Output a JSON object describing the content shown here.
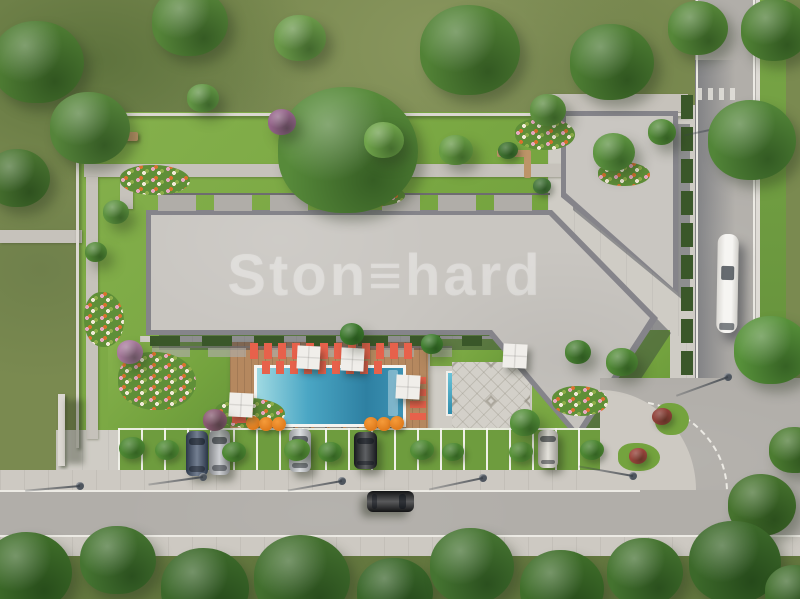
{
  "watermark": {
    "text": "Ston≡hard"
  },
  "palette": {
    "meadow": "#7a8a50",
    "lawn": "#74a33e",
    "lawnLight": "#86b14d",
    "paving": "#cfccc5",
    "path": "#c6c2bb",
    "road": "#b1aea9",
    "sidewalk": "#cdc9c2",
    "roofLight": "#c9c6c1",
    "roofEdge": "#85848a",
    "shadow": "#2e3440",
    "deck": "#b5885f",
    "coral": "#e7614b",
    "orangeUmb": "#e07b1c",
    "hedge": "#3a5729"
  },
  "scene": {
    "trees": [
      {
        "x": 38,
        "y": 62,
        "r": 46,
        "c": "#4e7c33"
      },
      {
        "x": 90,
        "y": 128,
        "r": 40,
        "c": "#55843a"
      },
      {
        "x": 18,
        "y": 178,
        "r": 32,
        "c": "#4a7531"
      },
      {
        "x": 190,
        "y": 22,
        "r": 38,
        "c": "#568539"
      },
      {
        "x": 300,
        "y": 38,
        "r": 26,
        "c": "#6b9a49"
      },
      {
        "x": 348,
        "y": 150,
        "r": 70,
        "c": "#578a3a"
      },
      {
        "x": 470,
        "y": 50,
        "r": 50,
        "c": "#528236"
      },
      {
        "x": 612,
        "y": 62,
        "r": 42,
        "c": "#4d7d33"
      },
      {
        "x": 548,
        "y": 110,
        "r": 18,
        "c": "#5d8f3f"
      },
      {
        "x": 698,
        "y": 28,
        "r": 30,
        "c": "#568739"
      },
      {
        "x": 775,
        "y": 30,
        "r": 34,
        "c": "#4f8034"
      },
      {
        "x": 752,
        "y": 140,
        "r": 44,
        "c": "#528538"
      },
      {
        "x": 772,
        "y": 350,
        "r": 38,
        "c": "#57913a"
      },
      {
        "x": 795,
        "y": 450,
        "r": 26,
        "c": "#4c7c31"
      },
      {
        "x": 762,
        "y": 505,
        "r": 34,
        "c": "#46732e"
      },
      {
        "x": 384,
        "y": 140,
        "r": 20,
        "c": "#6fa34a"
      },
      {
        "x": 456,
        "y": 150,
        "r": 17,
        "c": "#679c43"
      },
      {
        "x": 614,
        "y": 152,
        "r": 21,
        "c": "#5d9440"
      },
      {
        "x": 662,
        "y": 132,
        "r": 14,
        "c": "#548c39"
      },
      {
        "x": 282,
        "y": 122,
        "r": 14,
        "c": "#95648a"
      },
      {
        "x": 203,
        "y": 98,
        "r": 16,
        "c": "#639745"
      },
      {
        "x": 116,
        "y": 212,
        "r": 13,
        "c": "#5d9240"
      },
      {
        "x": 96,
        "y": 252,
        "r": 11,
        "c": "#548a38"
      },
      {
        "x": 352,
        "y": 334,
        "r": 12,
        "c": "#3e7b2e"
      },
      {
        "x": 432,
        "y": 344,
        "r": 11,
        "c": "#417f30"
      },
      {
        "x": 525,
        "y": 422,
        "r": 15,
        "c": "#55903a"
      },
      {
        "x": 578,
        "y": 352,
        "r": 13,
        "c": "#4a8234"
      },
      {
        "x": 622,
        "y": 362,
        "r": 16,
        "c": "#538c38"
      },
      {
        "x": 215,
        "y": 420,
        "r": 12,
        "c": "#8a5a72"
      },
      {
        "x": 130,
        "y": 352,
        "r": 13,
        "c": "#a8799c"
      },
      {
        "x": 28,
        "y": 572,
        "r": 44,
        "c": "#3f6e2a"
      },
      {
        "x": 118,
        "y": 560,
        "r": 38,
        "c": "#457431"
      },
      {
        "x": 205,
        "y": 588,
        "r": 44,
        "c": "#3c692a"
      },
      {
        "x": 302,
        "y": 578,
        "r": 48,
        "c": "#426f2e"
      },
      {
        "x": 395,
        "y": 592,
        "r": 38,
        "c": "#3a672a"
      },
      {
        "x": 472,
        "y": 566,
        "r": 42,
        "c": "#457431"
      },
      {
        "x": 562,
        "y": 588,
        "r": 42,
        "c": "#3f6e2a"
      },
      {
        "x": 645,
        "y": 572,
        "r": 38,
        "c": "#44732f"
      },
      {
        "x": 735,
        "y": 562,
        "r": 46,
        "c": "#3c692a"
      },
      {
        "x": 795,
        "y": 592,
        "r": 30,
        "c": "#426f2e"
      }
    ],
    "bushes": [
      {
        "x": 132,
        "y": 448,
        "r": 13,
        "c": "#4d8833"
      },
      {
        "x": 167,
        "y": 450,
        "r": 12,
        "c": "#528d36"
      },
      {
        "x": 234,
        "y": 452,
        "r": 12,
        "c": "#4d8833"
      },
      {
        "x": 297,
        "y": 450,
        "r": 13,
        "c": "#579138"
      },
      {
        "x": 330,
        "y": 452,
        "r": 12,
        "c": "#4d8833"
      },
      {
        "x": 422,
        "y": 450,
        "r": 12,
        "c": "#528d36"
      },
      {
        "x": 453,
        "y": 452,
        "r": 11,
        "c": "#4d8833"
      },
      {
        "x": 521,
        "y": 452,
        "r": 12,
        "c": "#579138"
      },
      {
        "x": 592,
        "y": 450,
        "r": 12,
        "c": "#4d8833"
      },
      {
        "x": 508,
        "y": 150,
        "r": 10,
        "c": "#3f7330"
      },
      {
        "x": 542,
        "y": 186,
        "r": 9,
        "c": "#45763a"
      },
      {
        "x": 662,
        "y": 416,
        "r": 10,
        "c": "#8f4038"
      },
      {
        "x": 638,
        "y": 456,
        "r": 9,
        "c": "#9a453c"
      }
    ],
    "flowerbeds": [
      {
        "x": 120,
        "y": 165,
        "w": 70,
        "h": 30
      },
      {
        "x": 330,
        "y": 183,
        "w": 75,
        "h": 24
      },
      {
        "x": 515,
        "y": 118,
        "w": 60,
        "h": 32
      },
      {
        "x": 598,
        "y": 162,
        "w": 52,
        "h": 24
      },
      {
        "x": 84,
        "y": 292,
        "w": 40,
        "h": 55
      },
      {
        "x": 118,
        "y": 352,
        "w": 78,
        "h": 58
      },
      {
        "x": 215,
        "y": 398,
        "w": 70,
        "h": 30
      },
      {
        "x": 552,
        "y": 386,
        "w": 56,
        "h": 30
      }
    ],
    "benches": [
      {
        "x": 104,
        "y": 132,
        "w": 34,
        "h": 9
      },
      {
        "x": 284,
        "y": 124,
        "w": 26,
        "h": 8
      }
    ],
    "lounger_rows": [
      {
        "x": 250,
        "y": 343,
        "w": 168,
        "h": 16,
        "dir": "h"
      },
      {
        "x": 262,
        "y": 361,
        "w": 122,
        "h": 13,
        "dir": "h"
      },
      {
        "x": 410,
        "y": 374,
        "w": 16,
        "h": 46,
        "dir": "v"
      },
      {
        "x": 232,
        "y": 395,
        "w": 14,
        "h": 28,
        "dir": "v"
      }
    ],
    "umbrellas_white": [
      {
        "x": 297,
        "y": 346,
        "s": 23
      },
      {
        "x": 341,
        "y": 348,
        "s": 23
      },
      {
        "x": 396,
        "y": 375,
        "s": 24
      },
      {
        "x": 229,
        "y": 393,
        "s": 24
      },
      {
        "x": 503,
        "y": 344,
        "s": 24
      }
    ],
    "umbrellas_orange": [
      {
        "x": 253,
        "y": 423
      },
      {
        "x": 266,
        "y": 424
      },
      {
        "x": 279,
        "y": 424
      },
      {
        "x": 371,
        "y": 424
      },
      {
        "x": 384,
        "y": 424
      },
      {
        "x": 397,
        "y": 423
      }
    ],
    "cars": [
      {
        "x": 186,
        "y": 431,
        "w": 22,
        "h": 45,
        "c": "#3d4d66",
        "rot": 0
      },
      {
        "x": 209,
        "y": 430,
        "w": 21,
        "h": 45,
        "c": "#b9bcc1",
        "rot": 0
      },
      {
        "x": 289,
        "y": 429,
        "w": 22,
        "h": 43,
        "c": "#ccd0d4",
        "rot": 0
      },
      {
        "x": 354,
        "y": 432,
        "w": 23,
        "h": 37,
        "c": "#202327",
        "rot": 0
      },
      {
        "x": 538,
        "y": 430,
        "w": 20,
        "h": 38,
        "c": "#d9d6cd",
        "rot": 0
      },
      {
        "x": 380,
        "y": 478,
        "w": 21,
        "h": 47,
        "c": "#191a1c",
        "rot": 90
      }
    ],
    "bus": {
      "x": 717,
      "y": 234,
      "w": 21,
      "h": 99,
      "rot": 1
    },
    "lamps": [
      {
        "x": 80,
        "y": 486,
        "a": 175
      },
      {
        "x": 203,
        "y": 477,
        "a": 172
      },
      {
        "x": 342,
        "y": 481,
        "a": 170
      },
      {
        "x": 483,
        "y": 478,
        "a": 168
      },
      {
        "x": 633,
        "y": 476,
        "a": 190
      },
      {
        "x": 728,
        "y": 377,
        "a": 160
      },
      {
        "x": 738,
        "y": 124,
        "a": 168
      }
    ]
  }
}
